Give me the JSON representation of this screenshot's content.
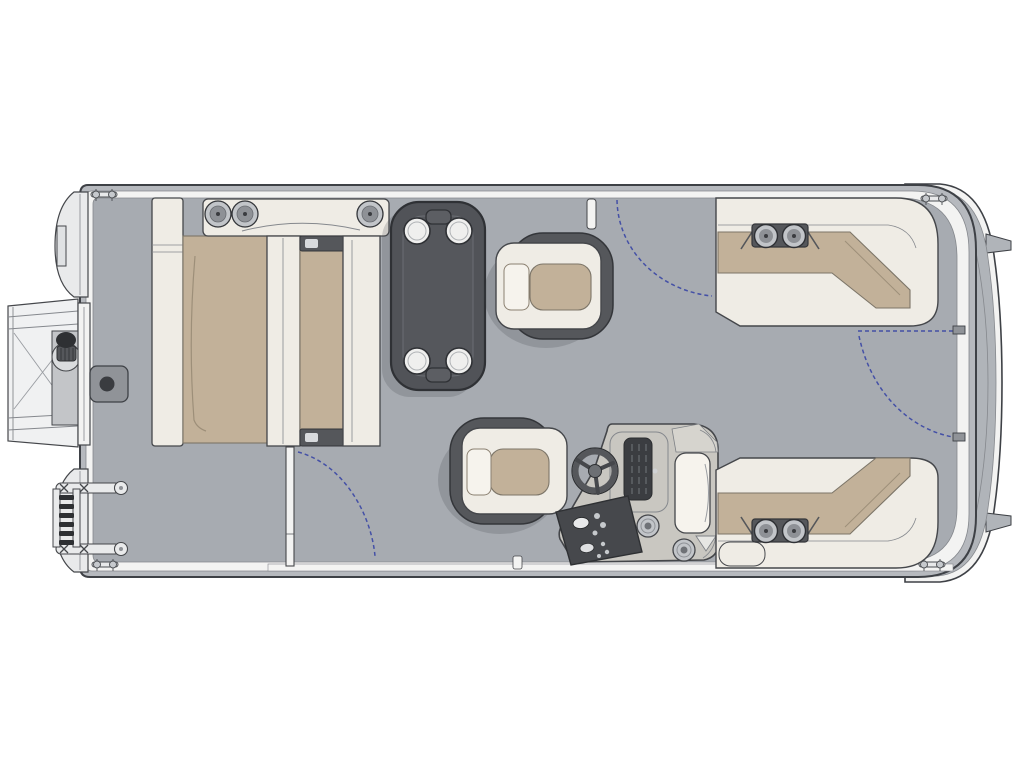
{
  "canvas": {
    "width": 1024,
    "height": 768
  },
  "diagram": {
    "type": "floorplan",
    "subject": "pontoon-boat-deck-top-view",
    "text_labels": []
  },
  "colors": {
    "background": "#ffffff",
    "outline": "#3e4146",
    "line_mid": "#85888d",
    "deck": "#a7abb1",
    "rim": "#b6b9be",
    "band": "#f3f3f2",
    "platform": "#b0b4b9",
    "seat": "#efece5",
    "seat_bright": "#f6f3ed",
    "seat_stroke": "#45474b",
    "tan": "#c2b199",
    "tan_outline": "#7c7568",
    "tan_seam": "#9d8f79",
    "dark": "#55575b",
    "dark_outline": "#34363a",
    "black": "#2e3033",
    "metal": "#c2c5c9",
    "metal_dark": "#8e9196",
    "console": "#c9c7c1",
    "console_light": "#d6d4ce",
    "panel": "#46484c",
    "gate_blue": "#4450a6",
    "box_gray": "#909398",
    "part_light": "#e9eaeb",
    "table": "#515358",
    "table_inner": "#55575c",
    "table_edge": "#2f3135",
    "shadow": "rgba(62,65,70,0.20)"
  },
  "components": {
    "hull": [
      "bow-pontoon-nose-top",
      "bow-pontoon-nose-bottom",
      "deck",
      "rub-rail-band",
      "stern-platform",
      "transom",
      "motor-mount-tab"
    ],
    "bow_hardware": [
      "bow-boarding-platform",
      "bow-gate-door",
      "navigation-light",
      "deck-storage-box",
      "boarding-ladder",
      "mooring-cleat"
    ],
    "furniture": [
      "bow-lounge-bench",
      "bow-lounge-left-seat",
      "bow-lounge-center-seat",
      "speaker-bracket",
      "pedestal-table",
      "cup-holder",
      "companion-captain-chair",
      "helm-captain-chair",
      "helm-console",
      "steering-wheel",
      "instrument-panel",
      "switch-panel",
      "flip-seat",
      "stern-lounge-top",
      "stern-lounge-bottom",
      "armrest-cup-holders"
    ],
    "gates": [
      "top-side-gate-swing",
      "bottom-side-gate-door",
      "bottom-side-gate-swing",
      "stern-gate-door",
      "stern-gate-swing"
    ]
  }
}
